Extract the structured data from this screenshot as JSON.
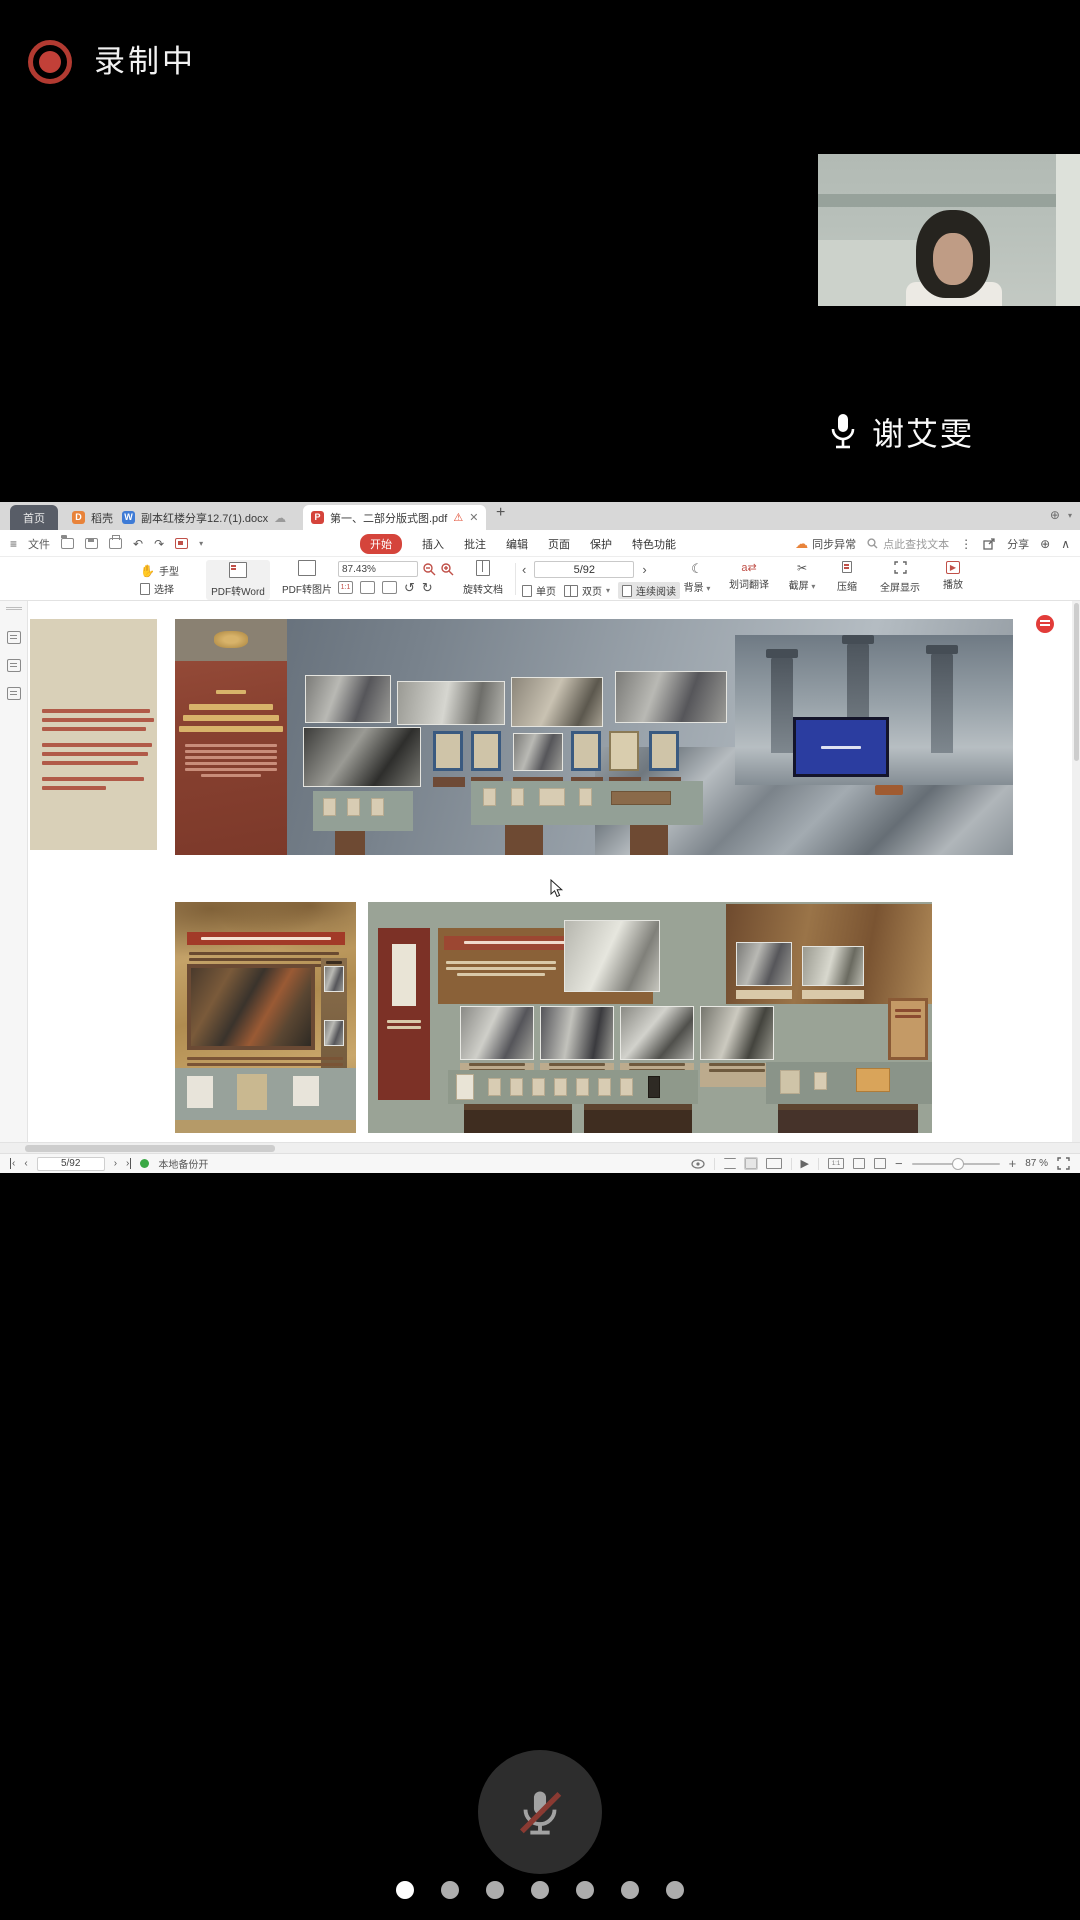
{
  "meeting": {
    "recording_label": "录制中",
    "participant_name": "谢艾雯",
    "carousel": {
      "dot_count": 7,
      "active_dot": 1
    }
  },
  "wps": {
    "tab_bar": {
      "home": "首页",
      "docer": "稻壳",
      "word_doc": "副本红楼分享12.7(1).docx",
      "pdf_doc": "第一、二部分版式图.pdf",
      "new_tab": "+"
    },
    "menu": {
      "file": "文件",
      "items": [
        "开始",
        "插入",
        "批注",
        "编辑",
        "页面",
        "保护",
        "特色功能"
      ],
      "active_item": "开始",
      "sync_status": "同步异常",
      "find_placeholder": "点此查找文本",
      "share": "分享"
    },
    "toolbar": {
      "hand": "手型",
      "select": "选择",
      "pdf_to_word": "PDF转Word",
      "pdf_to_image": "PDF转图片",
      "zoom_value": "87.43%",
      "rotate_doc": "旋转文档",
      "page_value": "5/92",
      "single_page": "单页",
      "double_page": "双页",
      "continuous": "连续阅读",
      "background": "背景",
      "translate": "划词翻译",
      "screenshot": "截屏",
      "compress": "压缩",
      "fullscreen": "全屏显示",
      "play": "播放"
    },
    "status": {
      "page_value": "5/92",
      "backup": "本地备份开",
      "zoom_percent": "87 %"
    }
  },
  "colors": {
    "recording_red": "#c24038",
    "wps_accent_red": "#d5443b",
    "sync_orange": "#e8833a",
    "backup_green": "#3aa845",
    "mute_slash_red": "#8a3a32"
  }
}
